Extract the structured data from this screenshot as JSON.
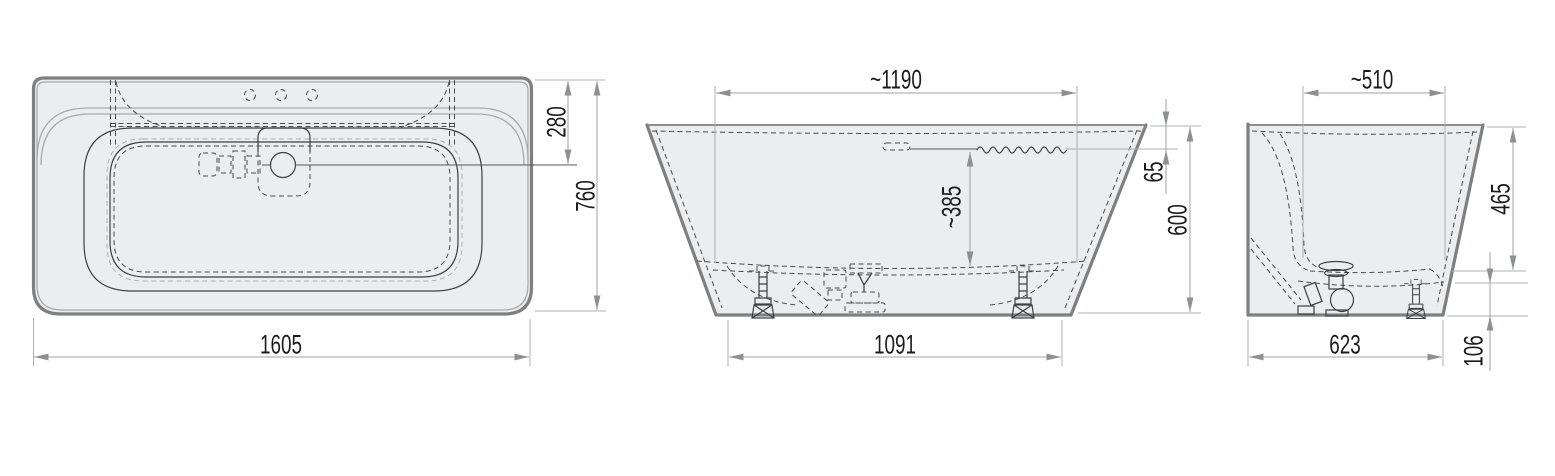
{
  "drawing": {
    "type": "bathtub-technical-drawing",
    "units": "mm",
    "colors": {
      "background": "#ffffff",
      "body_fill": "#ecedef",
      "shell_outline": "#7d7f83",
      "detail_line": "#3e3f42",
      "dimension_line": "#9ea0a4",
      "dimension_text": "#1b1b1d"
    },
    "views": {
      "top": {
        "dims": {
          "overall_width": "1605",
          "overall_depth": "760",
          "drain_offset": "280"
        }
      },
      "side": {
        "dims": {
          "rim_inner_length": "~1190",
          "base_length": "1091",
          "overall_height": "600",
          "waterline_drop": "65",
          "water_depth": "~385"
        }
      },
      "end": {
        "dims": {
          "rim_inner_width": "~510",
          "inner_depth": "465",
          "base_width": "623",
          "base_height": "106"
        }
      }
    }
  }
}
